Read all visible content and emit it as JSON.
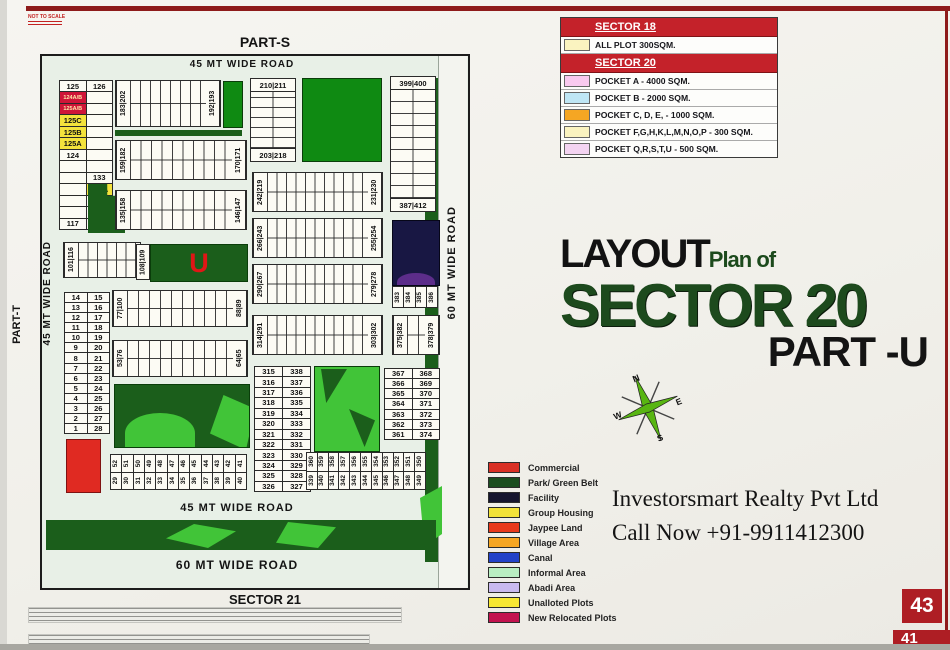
{
  "meta": {
    "not_to_scale": "NOT TO SCALE"
  },
  "labels": {
    "part_s": "PART-S",
    "part_t": "PART-T",
    "sector_21": "SECTOR 21",
    "road_45_top": "45 MT WIDE ROAD",
    "road_45_left": "45 MT WIDE ROAD",
    "road_45_bottom": "45 MT WIDE ROAD",
    "road_60_right": "60 MT WIDE ROAD",
    "road_60_bottom": "60 MT WIDE ROAD"
  },
  "legend_top": {
    "sections": [
      {
        "title": "SECTOR 18",
        "items": [
          {
            "color": "#faf3c0",
            "label": "ALL PLOT  300SQM."
          }
        ]
      },
      {
        "title": "SECTOR 20",
        "items": [
          {
            "color": "#f9c9ef",
            "label": "POCKET A    -  4000 SQM."
          },
          {
            "color": "#bfe6f5",
            "label": "POCKET B    -  2000 SQM."
          },
          {
            "color": "#f5a623",
            "label": "POCKET C, D, E, - 1000 SQM."
          },
          {
            "color": "#faf3c0",
            "label": "POCKET  F,G,H,K,L,M,N,O,P  -  300 SQM."
          },
          {
            "color": "#f4d4f2",
            "label": "POCKET Q,R,S,T,U   -  500 SQM."
          }
        ]
      }
    ]
  },
  "title_block": {
    "layout": "LAYOUT",
    "plan_of": "Plan of",
    "sector": "SECTOR 20",
    "part": "PART -U"
  },
  "compass": {
    "n": "N",
    "e": "E",
    "s": "S",
    "w": "W"
  },
  "legend_bottom": [
    {
      "color": "#d93025",
      "label": "Commercial"
    },
    {
      "color": "#1b4d1f",
      "label": "Park/ Green Belt"
    },
    {
      "color": "#16152e",
      "label": "Facility"
    },
    {
      "color": "#f2e239",
      "label": "Group Housing"
    },
    {
      "color": "#e8391c",
      "label": "Jaypee Land"
    },
    {
      "color": "#f5a623",
      "label": "Village Area"
    },
    {
      "color": "#2242c8",
      "label": "Canal"
    },
    {
      "color": "#b9eec2",
      "label": "Informal Area"
    },
    {
      "color": "#c9baf0",
      "label": "Abadi Area"
    },
    {
      "color": "#f7e733",
      "label": "Unalloted Plots"
    },
    {
      "color": "#c2134f",
      "label": "New Relocated Plots"
    }
  ],
  "company": {
    "name": "Investorsmart Realty Pvt Ltd",
    "phone": "Call Now +91-9911412300"
  },
  "page_number": "43",
  "page_number_partial": "41",
  "map": {
    "left_block": {
      "rows": [
        {
          "l": "125",
          "r": "126"
        },
        {
          "l": "124A/B",
          "lc": "red"
        },
        {
          "l": "125A/B",
          "lc": "red"
        },
        {
          "l": "125C",
          "lc": "yel"
        },
        {
          "l": "125B",
          "lc": "yel"
        },
        {
          "l": "125A",
          "lc": "yel"
        },
        {
          "l": "124"
        },
        {},
        {
          "r": "133"
        },
        {
          "r": "134A",
          "rc": "yel"
        },
        {
          "r": "134"
        },
        {},
        {
          "l": "117"
        }
      ]
    },
    "strips": {
      "s183": {
        "left": "183|202",
        "right": "192|193"
      },
      "s159": {
        "left": "159|182",
        "right": "170|171"
      },
      "s135": {
        "left": "135|158",
        "right": "146|147"
      },
      "s101": {
        "left": "101|116"
      },
      "s242": {
        "left": "242|219",
        "right": "231|230"
      },
      "s266": {
        "left": "266|243",
        "right": "255|254"
      },
      "s290": {
        "left": "290|267",
        "right": "279|278"
      },
      "s314": {
        "left": "314|291",
        "right": "303|302"
      },
      "s77": {
        "left": "77|100",
        "right": "88|89"
      },
      "s53": {
        "left": "53|76",
        "right": "64|65"
      }
    },
    "vblocks": {
      "b210": {
        "top": "210|211",
        "bottom": "203|218"
      },
      "b399": {
        "top": "399|400",
        "bottom": "387|412"
      },
      "b375": {
        "left": "375|382",
        "right": "378|379"
      }
    },
    "u_block": {
      "label": "U",
      "left": "108|109"
    },
    "facility_labels": [
      "383",
      "384",
      "385",
      "386"
    ],
    "pairs_left": [
      [
        "14",
        "15"
      ],
      [
        "13",
        "16"
      ],
      [
        "12",
        "17"
      ],
      [
        "11",
        "18"
      ],
      [
        "10",
        "19"
      ],
      [
        "9",
        "20"
      ],
      [
        "8",
        "21"
      ],
      [
        "7",
        "22"
      ],
      [
        "6",
        "23"
      ],
      [
        "5",
        "24"
      ],
      [
        "4",
        "25"
      ],
      [
        "3",
        "26"
      ],
      [
        "2",
        "27"
      ],
      [
        "1",
        "28"
      ]
    ],
    "block_315": [
      [
        "315",
        "338"
      ],
      [
        "316",
        "337"
      ],
      [
        "317",
        "336"
      ],
      [
        "318",
        "335"
      ],
      [
        "319",
        "334"
      ],
      [
        "320",
        "333"
      ],
      [
        "321",
        "332"
      ],
      [
        "322",
        "331"
      ],
      [
        "323",
        "330"
      ],
      [
        "324",
        "329"
      ],
      [
        "325",
        "328"
      ],
      [
        "326",
        "327"
      ]
    ],
    "block_367": [
      [
        "367",
        "368"
      ],
      [
        "366",
        "369"
      ],
      [
        "365",
        "370"
      ],
      [
        "364",
        "371"
      ],
      [
        "363",
        "372"
      ],
      [
        "362",
        "373"
      ],
      [
        "361",
        "374"
      ]
    ],
    "strip_29": {
      "top": [
        "52",
        "51",
        "50",
        "49",
        "48",
        "47",
        "46",
        "45",
        "44",
        "43",
        "42",
        "41"
      ],
      "bottom": [
        "29",
        "30",
        "31",
        "32",
        "33",
        "34",
        "35",
        "36",
        "37",
        "38",
        "39",
        "40"
      ]
    },
    "strip_339": {
      "top": [
        "360",
        "359",
        "358",
        "357",
        "356",
        "355",
        "354",
        "353",
        "352",
        "351",
        "350"
      ],
      "bottom": [
        "339",
        "340",
        "341",
        "342",
        "343",
        "344",
        "345",
        "346",
        "347",
        "348",
        "349"
      ]
    }
  }
}
